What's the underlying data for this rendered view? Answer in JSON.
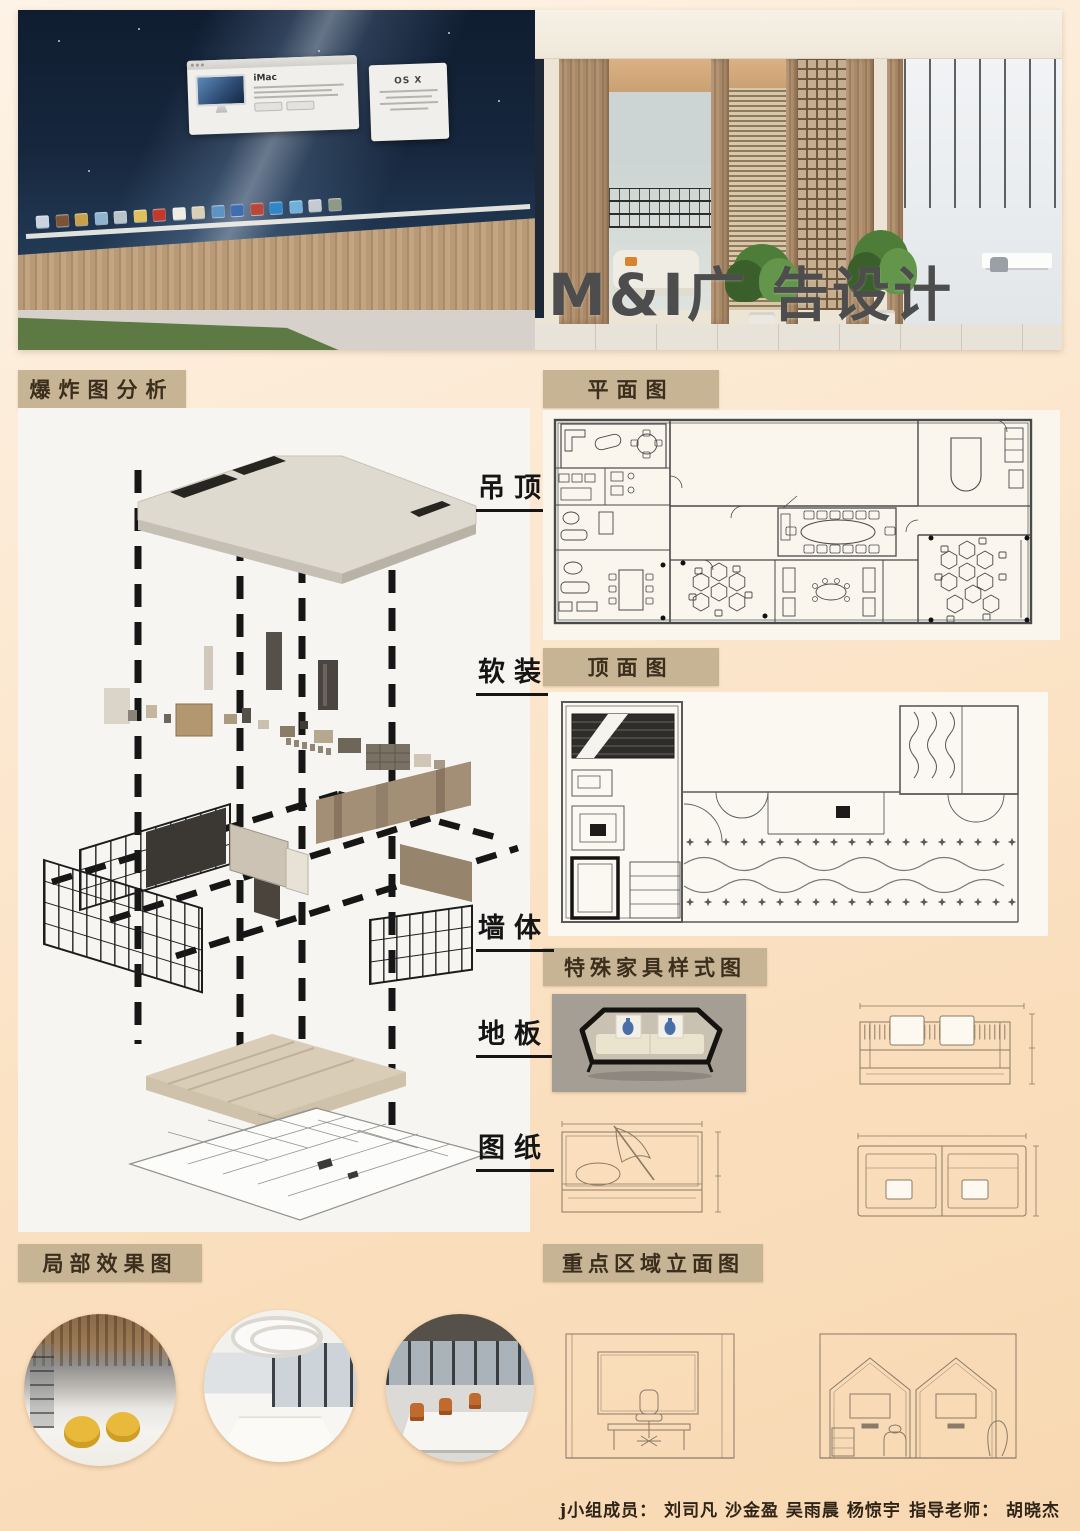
{
  "page": {
    "title_overlay": "M&I广 告设计",
    "credits": {
      "members_label": "j小组成员：",
      "members": "刘司凡 沙金盈 吴雨晨 杨惊宇",
      "advisor_label": "指导老师：",
      "advisor": "胡晓杰"
    }
  },
  "hero": {
    "screen": {
      "imac_window_title": "iMac",
      "osx_card_title": "OS X",
      "dock_icon_colors": [
        "#c9d4de",
        "#7a5435",
        "#c8a049",
        "#8fb3cf",
        "#b9c3ca",
        "#e0c05a",
        "#c0392b",
        "#efece4",
        "#d8cfb4",
        "#5e93c6",
        "#3f6db0",
        "#b9473a",
        "#2f86c9",
        "#6fb0dc",
        "#c6cbd2",
        "#8f9a86"
      ]
    }
  },
  "sections": {
    "exploded": {
      "label": "爆炸图分析",
      "layers": [
        {
          "name": "吊顶"
        },
        {
          "name": "软装"
        },
        {
          "name": "墙体"
        },
        {
          "name": "地板"
        },
        {
          "name": "图纸"
        }
      ]
    },
    "floor_plan": {
      "label": "平面图"
    },
    "ceiling_plan": {
      "label": "顶面图"
    },
    "furniture": {
      "label": "特殊家具样式图"
    },
    "partial_renders": {
      "label": "局部效果图"
    },
    "key_elevations": {
      "label": "重点区域立面图"
    }
  },
  "colors": {
    "page_background_top": "#fdf3e6",
    "page_background_bottom": "#f8d8b2",
    "section_label_background": "#c6b495",
    "section_label_text": "#3b2e1c",
    "title_overlay_text": "#4d4d4d",
    "layer_label_text": "#151515",
    "drawing_line": "#4a4a4a",
    "ceiling_slab": "#dedacf",
    "floor_slab": "#cfc2ab",
    "screen_wallpaper": "#16263c",
    "wood_wall": "#b2916f",
    "lattice_wood": "#6e593e",
    "grass": "#5e7a44"
  }
}
